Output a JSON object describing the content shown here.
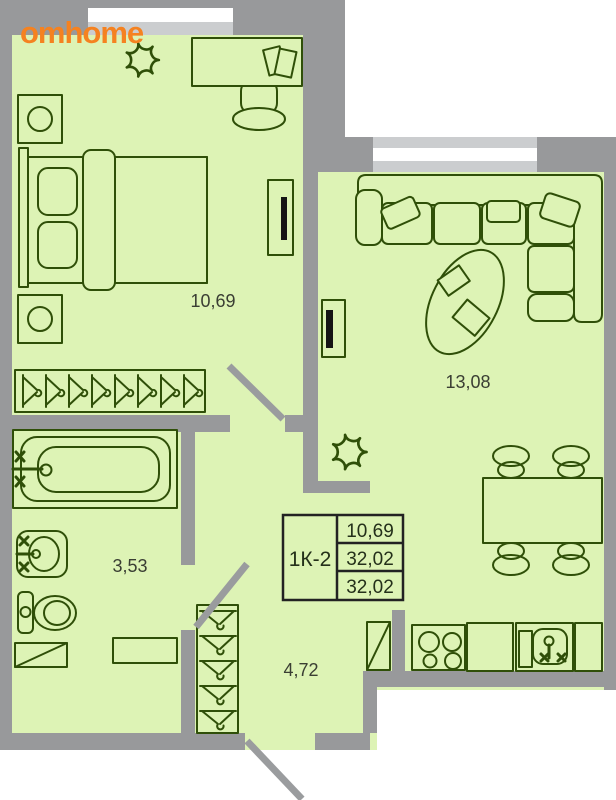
{
  "logo": {
    "text": "omhome",
    "color": "#f58220"
  },
  "plan": {
    "unit_table": {
      "type_label": "1К-2",
      "rows": [
        "10,69",
        "32,02",
        "32,02"
      ]
    },
    "rooms": [
      {
        "name": "bedroom",
        "area": "10,69"
      },
      {
        "name": "living-room",
        "area": "13,08"
      },
      {
        "name": "bathroom",
        "area": "3,53"
      },
      {
        "name": "hallway",
        "area": "4,72"
      }
    ],
    "colors": {
      "floor": "#ddf3b5",
      "wall": "#98999b",
      "window_frame": "#cbcdcf",
      "window_glass": "#ffffff",
      "furniture_line": "#2f4f08",
      "door_leaf": "#9a9c9e",
      "label_text": "#3a3e33",
      "table_border": "#222222",
      "tv_screen": "#151515"
    }
  }
}
